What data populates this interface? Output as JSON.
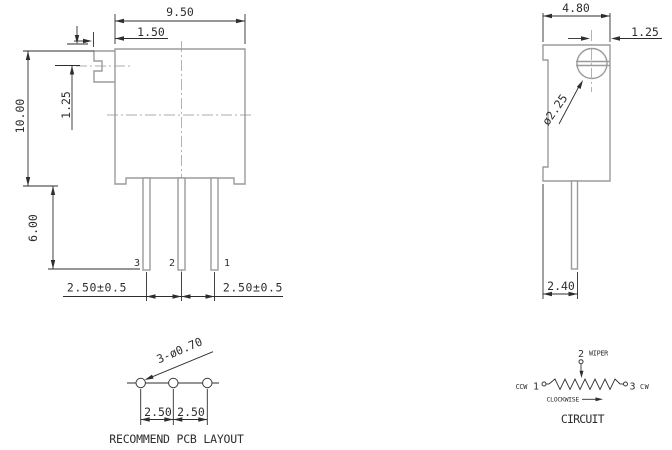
{
  "drawing": {
    "front_view": {
      "dim_body_width": "9.50",
      "dim_screw_protrusion": "1.50",
      "dim_slot_center": "1.25",
      "dim_body_height": "10.00",
      "dim_pin_length": "6.00",
      "pin3_label": "3",
      "pin2_label": "2",
      "pin1_label": "1",
      "dim_pitch_left": "2.50±0.5",
      "dim_pitch_right": "2.50±0.5"
    },
    "side_view": {
      "dim_body_depth": "4.80",
      "dim_screw_center_offset": "1.25",
      "dim_screw_diameter": "ø2.25",
      "dim_pin_row_width": "2.40"
    },
    "pcb_layout": {
      "hole_callout": "3-ø0.70",
      "dim_pitch_left": "2.50",
      "dim_pitch_right": "2.50",
      "caption": "RECOMMEND PCB LAYOUT"
    },
    "circuit": {
      "wiper_pin": "2",
      "wiper_label": "WIPER",
      "ccw_label": "CCW",
      "ccw_pin": "1",
      "cw_pin": "3",
      "cw_label": "CW",
      "rotation_label": "CLOCKWISE",
      "caption": "CIRCUIT"
    },
    "colors": {
      "part_outline": "#9b9b9b",
      "dimension_lines": "#2e2e2e",
      "centerlines": "#ababab",
      "background": "#ffffff"
    }
  }
}
